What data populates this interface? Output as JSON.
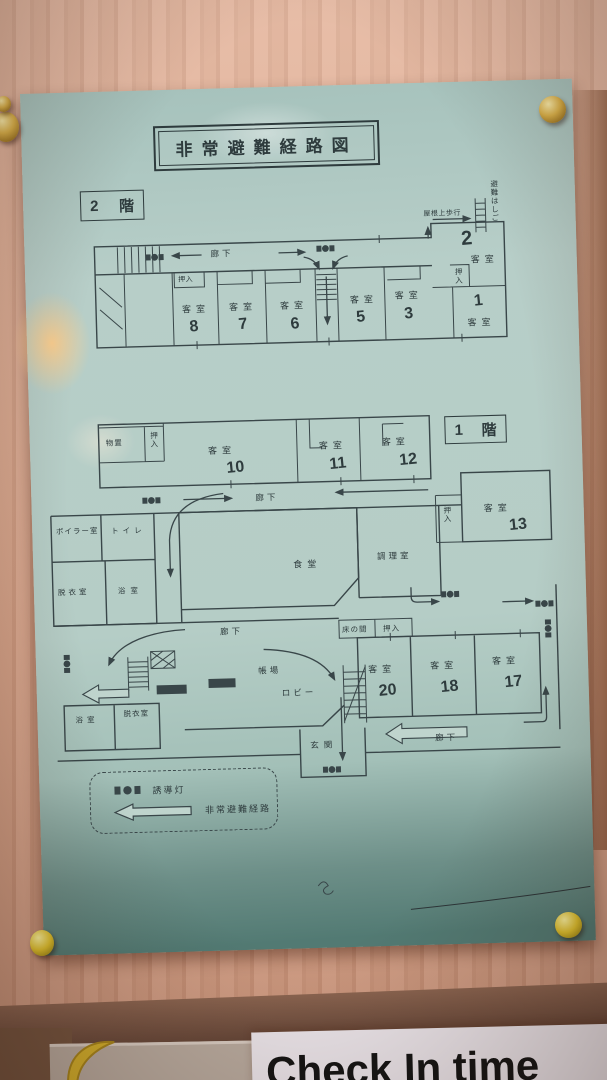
{
  "title": "非常避難経路図",
  "strings": {
    "guest_room": "客室",
    "closet": "押入",
    "corridor": "廊下",
    "floor_suffix": "階"
  },
  "floor2": {
    "number": "2",
    "roof_walk": "屋根上歩行",
    "escape_ladder": "避難はしご",
    "room_numbers": [
      "8",
      "7",
      "6",
      "5",
      "3",
      "2",
      "1"
    ]
  },
  "floor1": {
    "number": "1",
    "storage": "物置",
    "boiler_room": "ボイラー室",
    "toilet": "トイレ",
    "changing_room": "脱衣室",
    "bath": "浴室",
    "dining_room": "食堂",
    "kitchen": "調理室",
    "front_desk": "帳場",
    "lobby": "ロビー",
    "alcove": "床の間",
    "entrance": "玄関",
    "room_numbers": [
      "10",
      "11",
      "12",
      "13",
      "20",
      "18",
      "17"
    ]
  },
  "legend": {
    "guidance_light": "誘導灯",
    "evacuation_route": "非常避難経路"
  },
  "sign": {
    "text": "Check In time"
  },
  "colors": {
    "paper": "#b7cec8",
    "ink": "#394649",
    "wall": "#d8a78e",
    "pin_gold": "#d8b04a",
    "pin_yellow": "#ddbf2e",
    "sign_bg": "#ebe5ea"
  }
}
